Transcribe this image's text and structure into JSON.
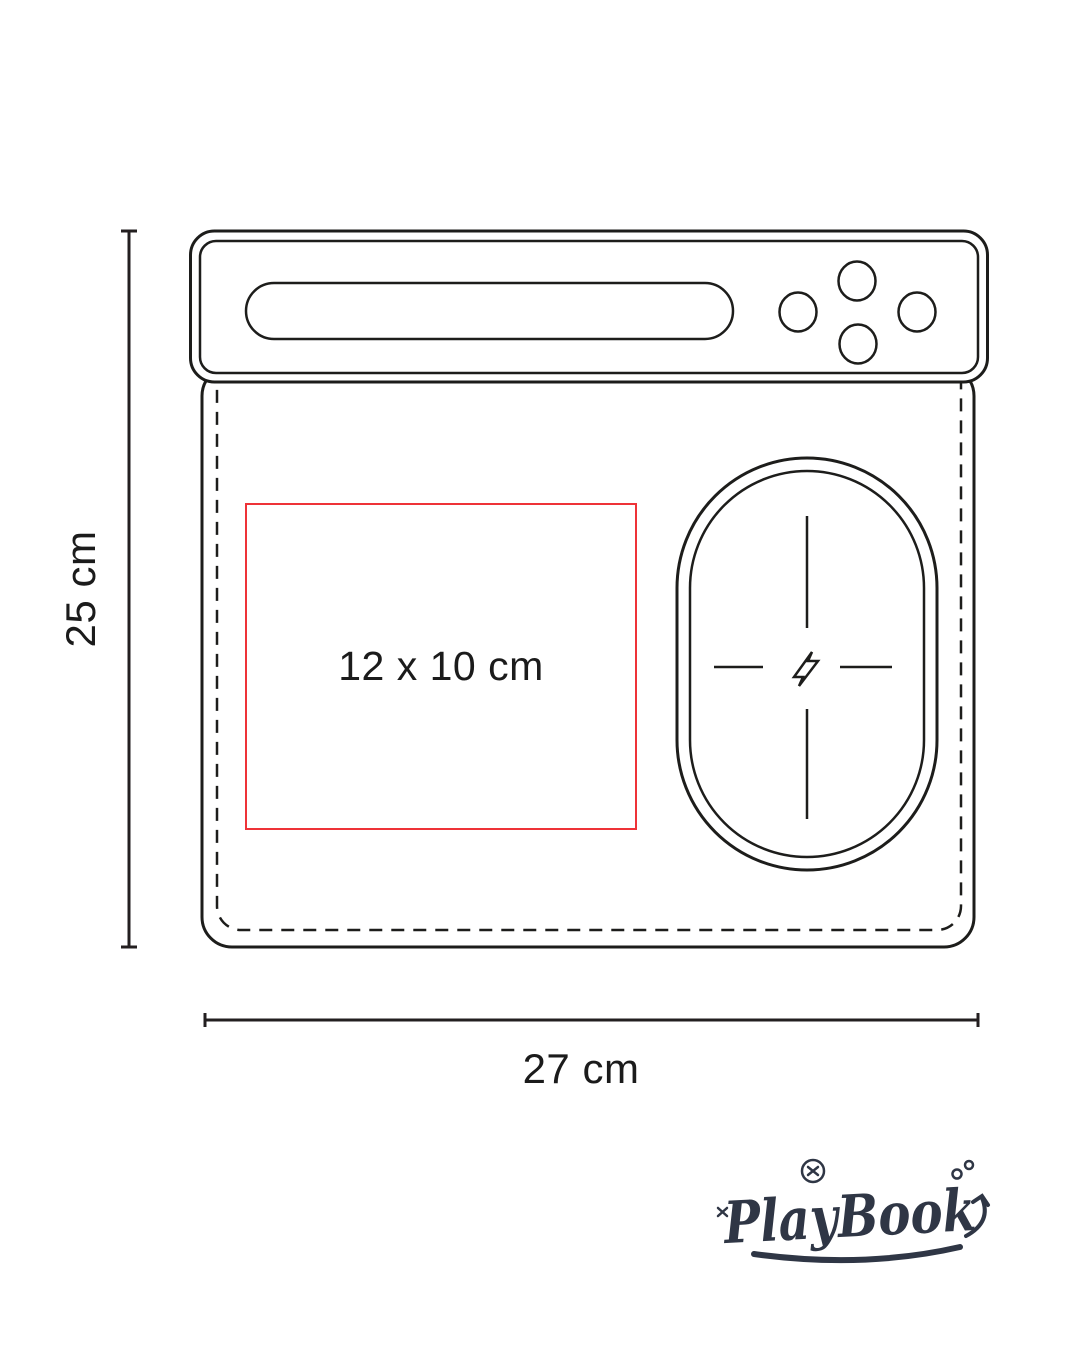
{
  "diagram": {
    "height_dimension": {
      "label": "25 cm"
    },
    "width_dimension": {
      "label": "27 cm"
    },
    "print_area": {
      "label": "12 x 10 cm",
      "border_color": "#ee3338"
    },
    "line_color": "#1d1d1b",
    "wireless_charge_icon": "lightning-bolt-icon"
  },
  "brand": {
    "wordmark": "PlayBook",
    "color": "#2f3645"
  }
}
